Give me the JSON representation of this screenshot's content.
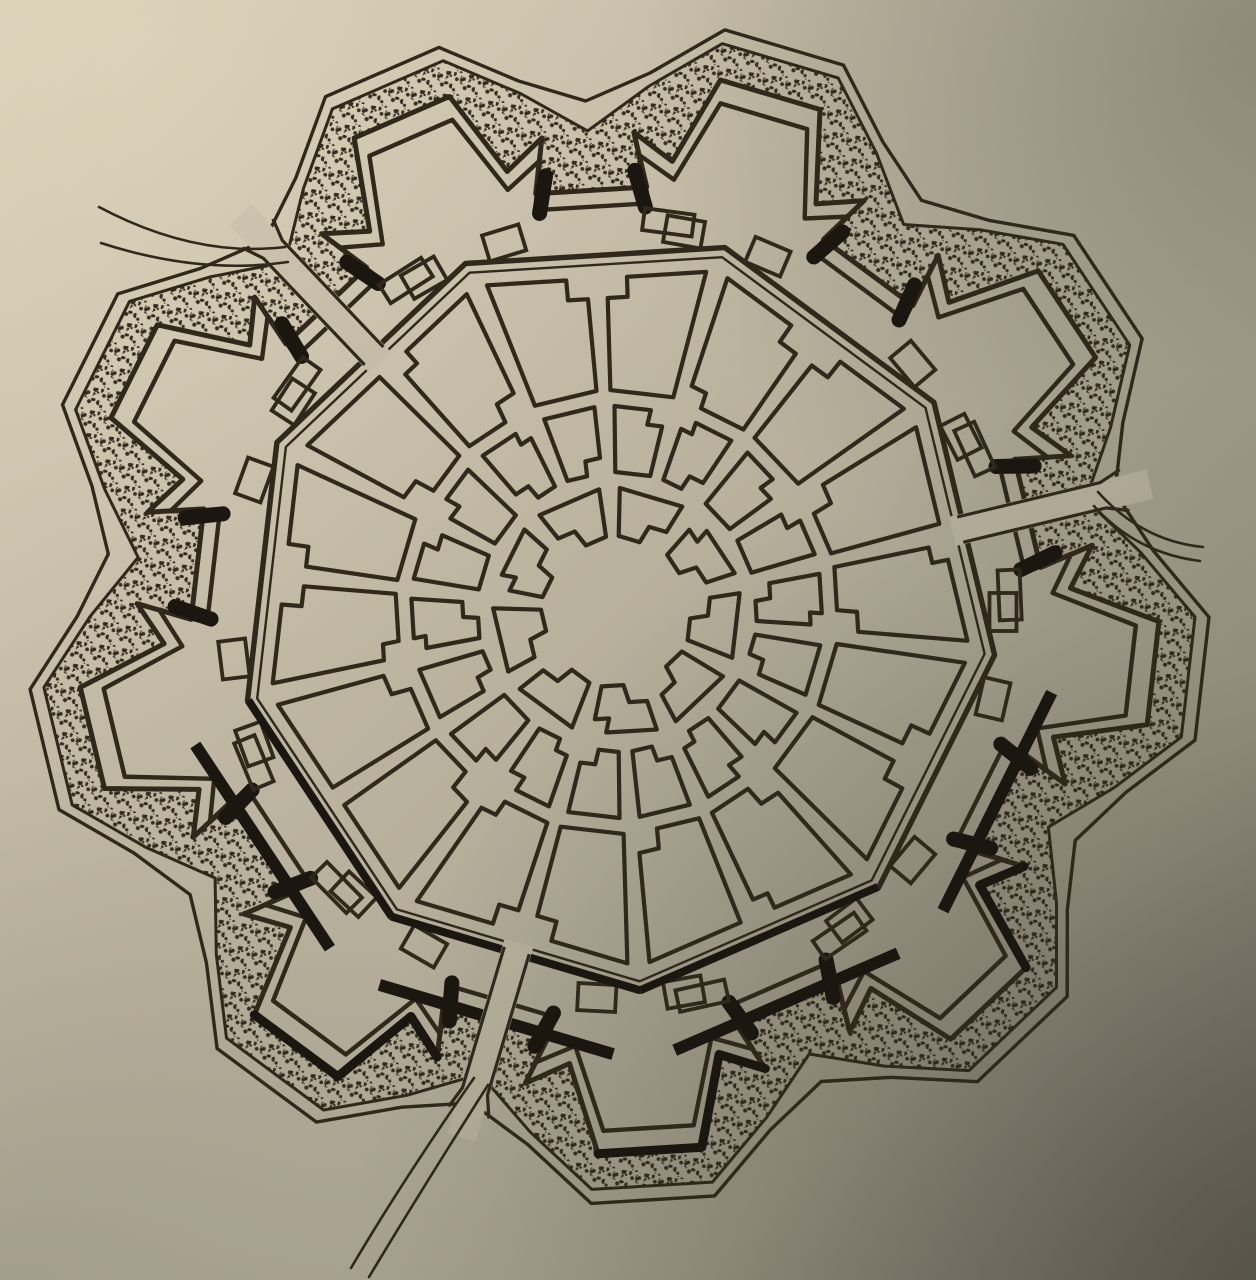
{
  "meta": {
    "description": "Book illustration: plan of a nine-bastion star-fort ideal city (Palmanova type) with radial streets, concentric ring roads, stippled moat and three gate roads, photographed on beige paper with light falling from upper left.",
    "visible_text": []
  },
  "palette": {
    "paper_light": "#d7ceb7",
    "paper_mid": "#c2baa5",
    "paper_shaded": "#a49d8c",
    "paper_dark": "#7c7869",
    "ink": "#30281a",
    "ink_heavy": "#1b1610",
    "stipple": "#2b2316",
    "lighten_tl": "rgba(238,228,202,0.30)",
    "shade_tr": "rgba(52,50,42,0.30)",
    "shade_br": "rgba(38,36,30,0.44)",
    "shade_bl": "rgba(60,58,48,0.15)"
  },
  "geometry": {
    "canvas": {
      "w": 1256,
      "h": 1280
    },
    "center": {
      "x": 617,
      "y": 612
    },
    "bastion_count": 9,
    "tip_angle_start": -73.5,
    "tip_angle_step": 40,
    "gate_angles": [
      -133.5,
      -13.5,
      106.5
    ],
    "covered_way": {
      "outer": {
        "tip": 592,
        "shoulder": 540,
        "notch": 512,
        "a_tip": 6,
        "a_shoulder": 13,
        "stroke": 3.4
      },
      "inner": {
        "tip": 578,
        "shoulder": 527,
        "notch": 482,
        "a_tip": 6,
        "a_shoulder": 13,
        "stroke": 3.0
      }
    },
    "rampart": {
      "outer": {
        "gorge": 426,
        "ear": 480,
        "hook": 454,
        "tip": 542,
        "a_gorge": 12.5,
        "a_ear": 14.5,
        "a_hook": 9.5,
        "a_tip": 5.5,
        "stroke": 5.0
      },
      "inner": {
        "gorge": 410,
        "ear": 458,
        "hook": 436,
        "tip": 519,
        "a_gorge": 12.0,
        "a_ear": 13.8,
        "a_hook": 9.0,
        "a_tip": 5.0,
        "stroke": 4.4
      }
    },
    "city_wall": {
      "outer_R": 380,
      "inner_R": 370,
      "stroke_outer": 5.4,
      "stroke_inner": 2.4
    },
    "plaza_r": 76,
    "rings": [
      {
        "r_in": 76,
        "r_out": 124,
        "blocks": 9,
        "a_margin": 4.8,
        "notch": 18,
        "follow_wall": false
      },
      {
        "r_in": 140,
        "r_out": 206,
        "blocks": 18,
        "a_margin": 2.8,
        "notch": 15,
        "follow_wall": false
      },
      {
        "r_in": 222,
        "r_out": 334,
        "blocks": 18,
        "a_margin": 1.8,
        "notch": 20,
        "follow_wall": true
      }
    ],
    "block_stroke": 4.2,
    "curtain_squares": {
      "r": 386,
      "offset_deg": 13.5,
      "w": 38,
      "h": 27,
      "stroke": 3.8
    },
    "gorge_buildings": {
      "r": 393,
      "offset_deg": 9,
      "w": 50,
      "h": 22,
      "stroke": 3.8
    },
    "shadows": {
      "curtain_angles": [
        26.5,
        66.5,
        106.5,
        146.5
      ],
      "bastion_angles": [
        46.5,
        86.5,
        126.5
      ],
      "wall_angles": [
        66.5,
        106.5,
        146.5
      ],
      "hook_stroke": 15,
      "curtain_stroke": 12,
      "face_stroke": 9,
      "wall_stroke": 8
    },
    "moat_stipple": {
      "tile": 23,
      "dots": 15,
      "tiny_dots": 6,
      "dot_min": 1.0,
      "dot_max": 2.6,
      "seed": 7
    },
    "causeway": {
      "width": 30,
      "r_in": 345,
      "r_out": 548,
      "edge_r_in": 353,
      "edge_r_mid": 500,
      "edge_r_out": 522,
      "edge_offset": 13,
      "flare_offset": 21
    },
    "road_stroke": 2.6,
    "gates": [
      {
        "name": "northwest",
        "angle": -133.5,
        "road_a": [
          [
            285,
            247
          ],
          [
            195,
            258
          ],
          [
            99,
            207
          ]
        ],
        "road_b": [
          [
            288,
            262
          ],
          [
            200,
            275
          ],
          [
            101,
            243
          ]
        ]
      },
      {
        "name": "east",
        "angle": -13.5,
        "road_a": [
          [
            1098,
            492
          ],
          [
            1142,
            541
          ],
          [
            1203,
            547
          ]
        ],
        "road_b": [
          [
            1094,
            506
          ],
          [
            1136,
            553
          ],
          [
            1200,
            561
          ]
        ]
      },
      {
        "name": "south",
        "angle": 106.5,
        "road_a": [
          [
            474,
            1078
          ],
          [
            403,
            1180
          ],
          [
            351,
            1268
          ]
        ],
        "road_b": [
          [
            488,
            1085
          ],
          [
            420,
            1192
          ],
          [
            369,
            1277
          ]
        ]
      }
    ]
  },
  "features": {
    "central_plaza_sides": 9,
    "radial_streets_inner": 9,
    "radial_streets_outer": 18,
    "ring_roads": 2,
    "city_blocks_total": 45,
    "curtain_magazines": 18,
    "gorge_buildings": 9,
    "gates": 3
  }
}
